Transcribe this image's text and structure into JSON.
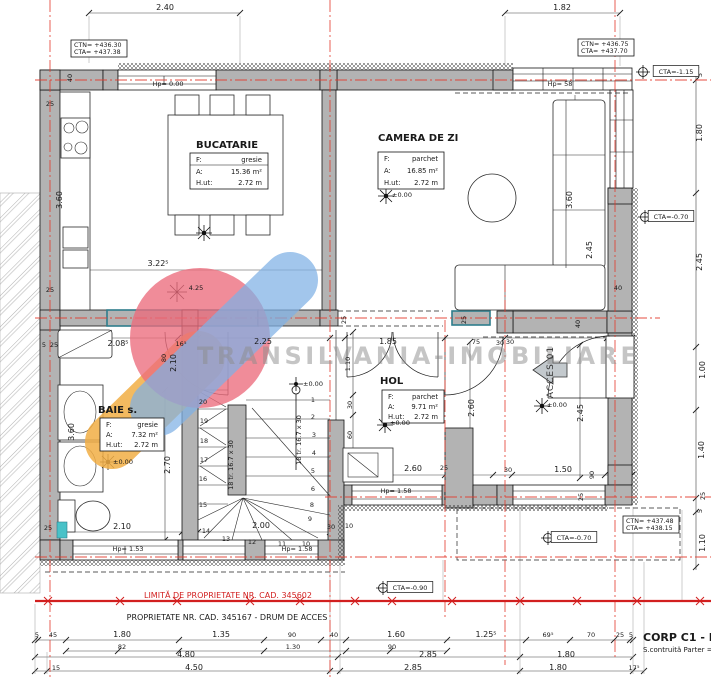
{
  "watermark": {
    "text": "TRANSILVANIA-IMOBILIARE"
  },
  "rooms": [
    {
      "name": "BUCATARIE",
      "rows": [
        {
          "k": "F:",
          "v": "gresie"
        },
        {
          "k": "A:",
          "v": "15.36 m²"
        },
        {
          "k": "H.ut:",
          "v": "2.72 m"
        }
      ]
    },
    {
      "name": "CAMERA DE ZI",
      "rows": [
        {
          "k": "F:",
          "v": "parchet"
        },
        {
          "k": "A:",
          "v": "16.85 m²"
        },
        {
          "k": "H.ut:",
          "v": "2.72 m"
        }
      ]
    },
    {
      "name": "BAIE s.",
      "rows": [
        {
          "k": "F:",
          "v": "gresie"
        },
        {
          "k": "A:",
          "v": "7.32 m²"
        },
        {
          "k": "H.ut:",
          "v": "2.72 m"
        }
      ]
    },
    {
      "name": "HOL",
      "rows": [
        {
          "k": "F:",
          "v": "parchet"
        },
        {
          "k": "A:",
          "v": "9.71 m²"
        },
        {
          "k": "H.ut:",
          "v": "2.72 m"
        }
      ]
    }
  ],
  "elevation_boxes": [
    {
      "l1": "CTN= +436.30",
      "l2": "CTA= +437.38"
    },
    {
      "l1": "CTN= +436.75",
      "l2": "CTA= +437.70"
    },
    {
      "l1": "CTN= +437.48",
      "l2": "CTA= +438.15"
    }
  ],
  "property": {
    "limit_text": "LIMITĂ DE PROPRIETATE NR. CAD. 345602",
    "access_text": "PROPRIETATE NR. CAD. 345167 - DRUM DE ACCES"
  },
  "corp": {
    "title": "CORP C1 - NR",
    "subtitle": "S.contruită Parter = 72"
  },
  "stairs": {
    "label": "18 tr. 16.7 x 30",
    "numbers": [
      {
        "n": "1",
        "x": 313,
        "y": 402
      },
      {
        "n": "2",
        "x": 313,
        "y": 419
      },
      {
        "n": "3",
        "x": 314,
        "y": 437
      },
      {
        "n": "4",
        "x": 314,
        "y": 455
      },
      {
        "n": "5",
        "x": 313,
        "y": 473
      },
      {
        "n": "6",
        "x": 313,
        "y": 491
      },
      {
        "n": "8",
        "x": 312,
        "y": 507
      },
      {
        "n": "9",
        "x": 310,
        "y": 521
      },
      {
        "n": "10",
        "x": 306,
        "y": 546
      },
      {
        "n": "11",
        "x": 282,
        "y": 546
      },
      {
        "n": "12",
        "x": 252,
        "y": 544
      },
      {
        "n": "13",
        "x": 226,
        "y": 541
      },
      {
        "n": "14",
        "x": 206,
        "y": 533
      },
      {
        "n": "15",
        "x": 203,
        "y": 507
      },
      {
        "n": "16",
        "x": 203,
        "y": 481
      },
      {
        "n": "17",
        "x": 204,
        "y": 462
      },
      {
        "n": "18",
        "x": 204,
        "y": 443
      },
      {
        "n": "19",
        "x": 204,
        "y": 423
      },
      {
        "n": "20",
        "x": 203,
        "y": 404
      }
    ]
  },
  "annotations": [
    {
      "t": "2.40",
      "x": 165,
      "y": 10
    },
    {
      "t": "1.82",
      "x": 562,
      "y": 10
    },
    {
      "t": "5",
      "x": 702,
      "y": 75,
      "r": -90,
      "c": "sm"
    },
    {
      "t": "1.80",
      "x": 702,
      "y": 133,
      "r": -90
    },
    {
      "t": "2.45",
      "x": 702,
      "y": 262,
      "r": -90
    },
    {
      "t": "1.00",
      "x": 705,
      "y": 370,
      "r": -90
    },
    {
      "t": "1.40",
      "x": 704,
      "y": 450,
      "r": -90
    },
    {
      "t": "25",
      "x": 705,
      "y": 496,
      "r": -90,
      "c": "sm"
    },
    {
      "t": "5",
      "x": 702,
      "y": 511,
      "r": -90,
      "c": "sm"
    },
    {
      "t": "1.10",
      "x": 705,
      "y": 543,
      "r": -90
    },
    {
      "t": "40",
      "x": 72,
      "y": 78,
      "r": -90,
      "c": "sm"
    },
    {
      "t": "25",
      "x": 50,
      "y": 106,
      "c": "sm"
    },
    {
      "t": "3.60",
      "x": 62,
      "y": 200,
      "r": -90
    },
    {
      "t": "25",
      "x": 50,
      "y": 292,
      "c": "sm"
    },
    {
      "t": "5",
      "x": 44,
      "y": 347,
      "c": "sm"
    },
    {
      "t": "25",
      "x": 54,
      "y": 347,
      "c": "sm"
    },
    {
      "t": "3.60",
      "x": 74,
      "y": 432,
      "r": -90
    },
    {
      "t": "2.70",
      "x": 170,
      "y": 465,
      "r": -90
    },
    {
      "t": "25",
      "x": 48,
      "y": 530,
      "c": "sm"
    },
    {
      "t": "2.10",
      "x": 122,
      "y": 529
    },
    {
      "t": "Hp= 0.00",
      "x": 168,
      "y": 86,
      "c": "hp"
    },
    {
      "t": "3.22⁵",
      "x": 158,
      "y": 266
    },
    {
      "t": "4.25",
      "x": 196,
      "y": 290,
      "c": "sm"
    },
    {
      "t": "2.08⁵",
      "x": 118,
      "y": 346
    },
    {
      "t": "16⁵",
      "x": 181,
      "y": 346,
      "c": "sm"
    },
    {
      "t": "80",
      "x": 166,
      "y": 358,
      "r": -90,
      "c": "sm"
    },
    {
      "t": "2.10",
      "x": 176,
      "y": 363,
      "r": -90
    },
    {
      "t": "25",
      "x": 346,
      "y": 320,
      "r": -90,
      "c": "sm"
    },
    {
      "t": "2.25",
      "x": 263,
      "y": 344
    },
    {
      "t": "1.85",
      "x": 388,
      "y": 344
    },
    {
      "t": "75",
      "x": 476,
      "y": 344,
      "c": "sm"
    },
    {
      "t": "30",
      "x": 510,
      "y": 344,
      "c": "sm"
    },
    {
      "t": "25",
      "x": 466,
      "y": 320,
      "r": -90,
      "c": "sm"
    },
    {
      "t": "40",
      "x": 580,
      "y": 324,
      "r": -90,
      "c": "sm"
    },
    {
      "t": "40",
      "x": 618,
      "y": 290,
      "c": "sm"
    },
    {
      "t": "1.10",
      "x": 350,
      "y": 364,
      "r": -90,
      "c": "sm"
    },
    {
      "t": "30",
      "x": 352,
      "y": 405,
      "r": -90,
      "c": "sm"
    },
    {
      "t": "60",
      "x": 352,
      "y": 435,
      "r": -90,
      "c": "sm"
    },
    {
      "t": "2.60",
      "x": 474,
      "y": 408,
      "r": -90
    },
    {
      "t": "2.45",
      "x": 583,
      "y": 413,
      "r": -90
    },
    {
      "t": "2.60",
      "x": 413,
      "y": 471
    },
    {
      "t": "30",
      "x": 508,
      "y": 472,
      "c": "sm"
    },
    {
      "t": "1.50",
      "x": 563,
      "y": 472
    },
    {
      "t": "90",
      "x": 594,
      "y": 475,
      "r": -90,
      "c": "sm"
    },
    {
      "t": "25",
      "x": 583,
      "y": 497,
      "r": -90,
      "c": "sm"
    },
    {
      "t": "Hp= 1.58",
      "x": 396,
      "y": 493,
      "c": "hp"
    },
    {
      "t": "10",
      "x": 349,
      "y": 528,
      "c": "sm"
    },
    {
      "t": "30",
      "x": 331,
      "y": 529,
      "c": "sm"
    },
    {
      "t": "30",
      "x": 500,
      "y": 345,
      "c": "sm"
    },
    {
      "t": "25",
      "x": 444,
      "y": 470,
      "c": "sm"
    },
    {
      "t": "Hp= 58",
      "x": 560,
      "y": 86,
      "c": "hp"
    },
    {
      "t": "3.60",
      "x": 572,
      "y": 200,
      "r": -90
    },
    {
      "t": "2.45",
      "x": 592,
      "y": 250,
      "r": -90
    },
    {
      "t": "ACCES 01",
      "x": 553,
      "y": 372,
      "r": -90,
      "c": "acc"
    },
    {
      "t": "2.00",
      "x": 261,
      "y": 528
    },
    {
      "t": "Hp= 1.58",
      "x": 297,
      "y": 551,
      "c": "hp"
    },
    {
      "t": "Hp= 1.53",
      "x": 128,
      "y": 551,
      "c": "hp"
    },
    {
      "t": "18 tr. 16.7 x 30",
      "x": 233,
      "y": 465,
      "r": -90,
      "c": "sm"
    },
    {
      "t": "18 tr. 16.7 x 30",
      "x": 301,
      "y": 440,
      "r": -90,
      "c": "sm"
    },
    {
      "t": "±0.00",
      "x": 402,
      "y": 197,
      "c": "sm"
    },
    {
      "t": "±0.00",
      "x": 123,
      "y": 464,
      "c": "sm"
    },
    {
      "t": "±0.00",
      "x": 400,
      "y": 425,
      "c": "sm"
    },
    {
      "t": "±0.00",
      "x": 557,
      "y": 407,
      "c": "sm"
    },
    {
      "t": "±0.00",
      "x": 313,
      "y": 386,
      "c": "sm"
    },
    {
      "t": "5",
      "x": 37,
      "y": 637,
      "c": "sm"
    },
    {
      "t": "45",
      "x": 53,
      "y": 637,
      "c": "sm"
    },
    {
      "t": "1.80",
      "x": 122,
      "y": 637
    },
    {
      "t": "1.35",
      "x": 221,
      "y": 637
    },
    {
      "t": "90",
      "x": 292,
      "y": 637,
      "c": "sm"
    },
    {
      "t": "40",
      "x": 334,
      "y": 637,
      "c": "sm"
    },
    {
      "t": "1.60",
      "x": 396,
      "y": 637
    },
    {
      "t": "1.25⁵",
      "x": 486,
      "y": 637
    },
    {
      "t": "69⁵",
      "x": 548,
      "y": 637,
      "c": "sm"
    },
    {
      "t": "70",
      "x": 591,
      "y": 637,
      "c": "sm"
    },
    {
      "t": "25",
      "x": 620,
      "y": 637,
      "c": "sm"
    },
    {
      "t": "5",
      "x": 631,
      "y": 637,
      "c": "sm"
    },
    {
      "t": "82",
      "x": 122,
      "y": 649,
      "c": "sm"
    },
    {
      "t": "1.30",
      "x": 293,
      "y": 649,
      "c": "sm"
    },
    {
      "t": "90",
      "x": 392,
      "y": 649,
      "c": "sm"
    },
    {
      "t": "4.80",
      "x": 186,
      "y": 657
    },
    {
      "t": "2.85",
      "x": 428,
      "y": 657
    },
    {
      "t": "1.80",
      "x": 566,
      "y": 657
    },
    {
      "t": "15",
      "x": 56,
      "y": 670,
      "c": "sm"
    },
    {
      "t": "4.50",
      "x": 194,
      "y": 670
    },
    {
      "t": "2.85",
      "x": 413,
      "y": 670
    },
    {
      "t": "1.80",
      "x": 558,
      "y": 670
    },
    {
      "t": "17⁵",
      "x": 634,
      "y": 670,
      "c": "sm"
    },
    {
      "t": "CTA=-1.15",
      "x": 676,
      "y": 74,
      "c": "sm",
      "box": 1
    },
    {
      "t": "CTA=-0.70",
      "x": 671,
      "y": 219,
      "c": "sm",
      "box": 1
    },
    {
      "t": "CTA=-0.70",
      "x": 574,
      "y": 540,
      "c": "sm",
      "box": 1
    },
    {
      "t": "CTA=-0.90",
      "x": 410,
      "y": 590,
      "c": "sm",
      "box": 1
    }
  ]
}
